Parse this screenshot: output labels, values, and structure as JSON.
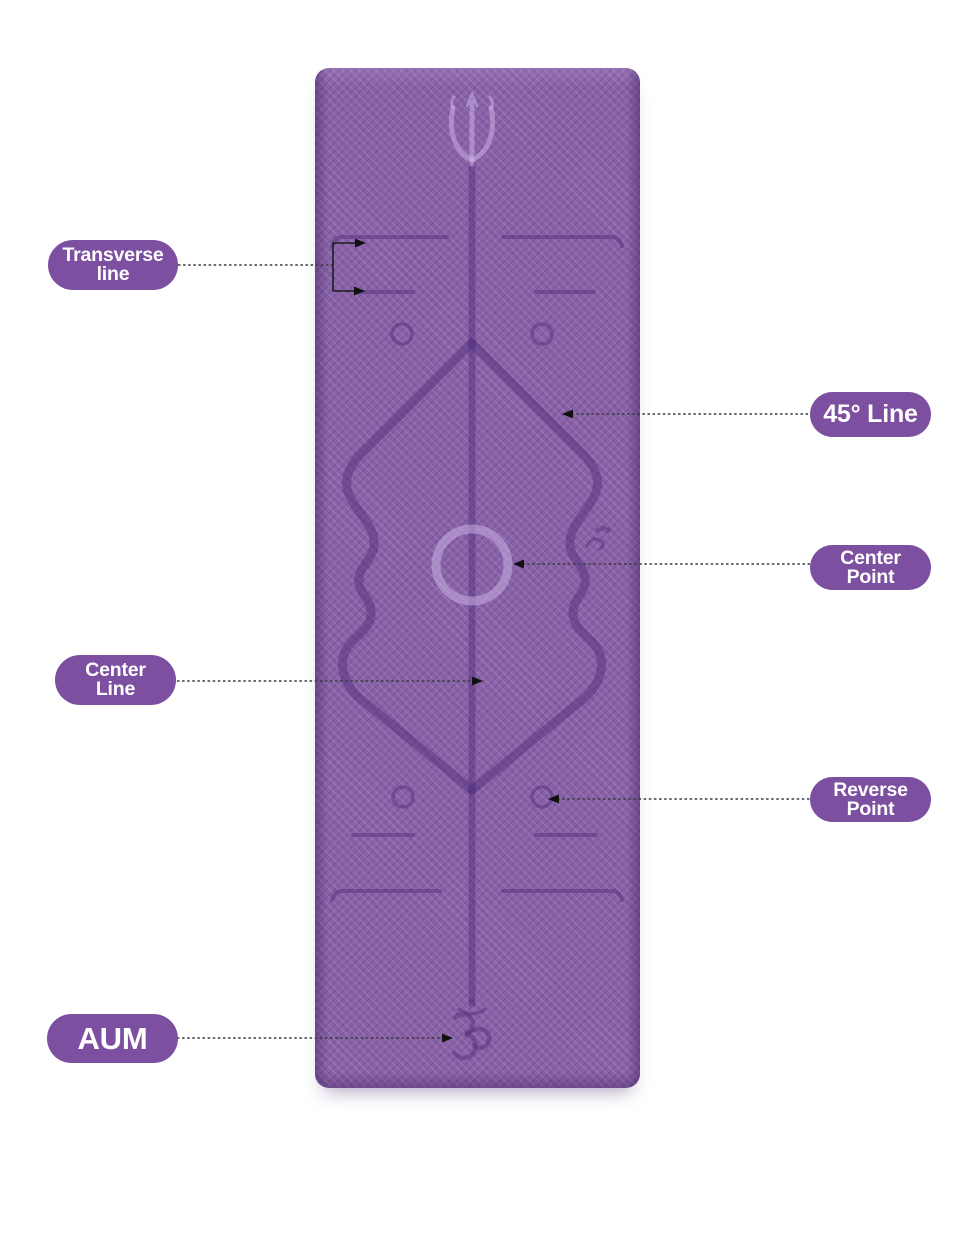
{
  "image": {
    "type": "annotated product diagram",
    "subject": "yoga mat with alignment guide lines",
    "background_color": "#ffffff"
  },
  "mat": {
    "base_color": "#8a62a8",
    "engraving_dark_color": "#53327e",
    "engraving_light_color": "#c9aee2",
    "top_symbol": "trident-icon",
    "bottom_symbol": "om-icon"
  },
  "annotations": {
    "pill_color": "#7d4fa0",
    "pill_text_color": "#ffffff",
    "transverse_line": {
      "line1": "Transverse",
      "line2": "line"
    },
    "line_45": {
      "text": "45° Line"
    },
    "center_point": {
      "line1": "Center",
      "line2": "Point"
    },
    "center_line": {
      "line1": "Center",
      "line2": "Line"
    },
    "reverse_point": {
      "line1": "Reverse",
      "line2": "Point"
    },
    "aum": {
      "text": "AUM"
    }
  }
}
